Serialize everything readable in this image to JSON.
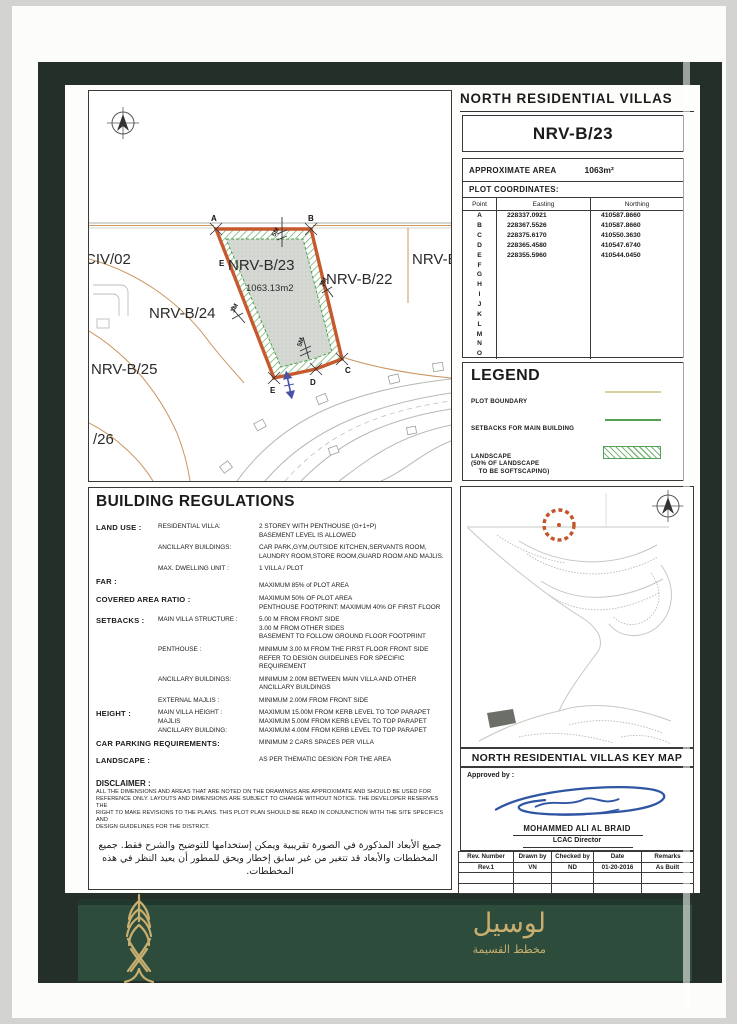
{
  "header": {
    "title": "NORTH RESIDENTIAL VILLAS",
    "plot_number": "NRV-B/23"
  },
  "area_box": {
    "label": "APPROXIMATE AREA",
    "value": "1063m²"
  },
  "coordinates": {
    "title": "PLOT COORDINATES:",
    "columns": [
      "Point",
      "Easting",
      "Northing"
    ],
    "rows": [
      {
        "point": "A",
        "easting": "228337.0921",
        "northing": "410587.8660"
      },
      {
        "point": "B",
        "easting": "228367.5526",
        "northing": "410587.8660"
      },
      {
        "point": "C",
        "easting": "228375.6170",
        "northing": "410550.3630"
      },
      {
        "point": "D",
        "easting": "228365.4580",
        "northing": "410547.6740"
      },
      {
        "point": "E",
        "easting": "228355.5960",
        "northing": "410544.0450"
      },
      {
        "point": "F",
        "easting": "",
        "northing": ""
      },
      {
        "point": "G",
        "easting": "",
        "northing": ""
      },
      {
        "point": "H",
        "easting": "",
        "northing": ""
      },
      {
        "point": "I",
        "easting": "",
        "northing": ""
      },
      {
        "point": "J",
        "easting": "",
        "northing": ""
      },
      {
        "point": "K",
        "easting": "",
        "northing": ""
      },
      {
        "point": "L",
        "easting": "",
        "northing": ""
      },
      {
        "point": "M",
        "easting": "",
        "northing": ""
      },
      {
        "point": "N",
        "easting": "",
        "northing": ""
      },
      {
        "point": "O",
        "easting": "",
        "northing": ""
      }
    ]
  },
  "legend": {
    "title": "LEGEND",
    "items": [
      {
        "label": "PLOT BOUNDARY",
        "symbol": "plot-boundary-line"
      },
      {
        "label": "SETBACKS FOR MAIN BUILDING",
        "symbol": "setback-line"
      },
      {
        "label": "LANDSCAPE\n(50% OF LANDSCAPE\n    TO BE SOFTSCAPING)",
        "symbol": "landscape-hatch"
      },
      {
        "label": "CONTOUR (ALL LEVELS ARE\n        SHOWN TO QNHD)",
        "symbol": "contour-line"
      },
      {
        "label": "PLOT VEHICULAR ACCESS",
        "symbol": "vehicular-access-arrow"
      }
    ]
  },
  "site_plan": {
    "labels": {
      "civ02": "CIV/02",
      "plot23": "NRV-B/23",
      "plot23_area": "1063.13m2",
      "plot22": "NRV-B/22",
      "plotB": "NRV-B",
      "plot24": "NRV-B/24",
      "plot25": "NRV-B/25",
      "plot26": "/26",
      "ptA": "A",
      "ptB": "B",
      "ptC": "C",
      "ptD": "D",
      "ptE": "E",
      "ptE2": "E"
    },
    "dimensions": {
      "top": "5M",
      "right": "3M",
      "left": "3M",
      "bottom": "5M"
    }
  },
  "key_map": {
    "title": "NORTH RESIDENTIAL VILLAS KEY MAP"
  },
  "regulations": {
    "title": "BUILDING REGULATIONS",
    "rows": [
      {
        "label": "LAND USE :",
        "sub": "RESIDENTIAL VILLA:",
        "value": "2 STOREY WITH PENTHOUSE  (G+1+P)\nBASEMENT LEVEL IS ALLOWED"
      },
      {
        "label": "",
        "sub": "ANCILLARY BUILDINGS:",
        "value": "CAR PARK,GYM,OUTSIDE KITCHEN,SERVANTS ROOM,\nLAUNDRY ROOM,STORE ROOM,GUARD ROOM AND MAJLIS."
      },
      {
        "label": "",
        "sub": "MAX. DWELLING UNIT :",
        "value": "1 VILLA / PLOT"
      },
      {
        "label": "FAR :",
        "sub": "",
        "value": "MAXIMUM 85% of PLOT AREA"
      },
      {
        "label": "COVERED AREA RATIO :",
        "sub": "",
        "value": "MAXIMUM 50% OF PLOT AREA\nPENTHOUSE FOOTPRINT: MAXIMUM 40% OF FIRST FLOOR"
      },
      {
        "label": "SETBACKS :",
        "sub": "MAIN VILLA STRUCTURE :",
        "value": "5.00 M FROM FRONT SIDE\n3.00 M FROM OTHER SIDES\nBASEMENT TO FOLLOW GROUND FLOOR FOOTPRINT"
      },
      {
        "label": "",
        "sub": "PENTHOUSE :",
        "value": "MINIMUM 3.00 M FROM THE FIRST FLOOR FRONT SIDE\nREFER TO DESIGN GUIDELINES FOR SPECIFIC REQUIREMENT"
      },
      {
        "label": "",
        "sub": "ANCILLARY BUILDINGS:",
        "value": "MINIMUM 2.00M BETWEEN MAIN VILLA AND OTHER\nANCILLARY BUILDINGS"
      },
      {
        "label": "",
        "sub": "EXTERNAL MAJLIS :",
        "value": "MINIMUM 2.00M FROM FRONT SIDE"
      },
      {
        "label": "HEIGHT :",
        "sub": "MAIN VILLA HEIGHT :\nMAJLIS\nANCILLARY BUILDING:",
        "value": "MAXIMUM 15.00M FROM KERB LEVEL TO TOP PARAPET\nMAXIMUM 5.00M FROM KERB LEVEL TO TOP PARAPET\nMAXIMUM 4.00M FROM KERB LEVEL TO TOP PARAPET"
      },
      {
        "label": "CAR PARKING REQUIREMENTS:",
        "sub": "",
        "value": "MINIMUM 2 CARS SPACES PER VILLA"
      },
      {
        "label": "LANDSCAPE :",
        "sub": "",
        "value": "AS PER THEMATIC DESIGN FOR THE AREA"
      }
    ]
  },
  "disclaimer": {
    "title": "DISCLAIMER :",
    "body": "ALL THE DIMENSIONS AND AREAS THAT ARE NOTED ON THE DRAWINGS ARE  APPROXIMATE AND SHOULD BE USED FOR\nREFERENCE ONLY.  LAYOUTS AND DIMENSIONS ARE SUBJECT TO CHANGE WITHOUT NOTICE.  THE DEVELOPER RESERVES THE\nRIGHT TO MAKE REVISIONS TO  THE PLANS. THIS PLOT PLAN SHOULD BE READ IN CONJUNCTION WITH THE SITE SPECIFICS AND\nDESIGN GUIDELINES FOR THE DISTRICT.",
    "arabic": "جميع الأبعاد المذكورة في الصورة تقريبية ويمكن إستخدامها للتوضيح والشرح فقط. جميع المخططات والأبعاد قد تتغير من غير سابق إخطار ويحق للمطور أن يعيد النظر في هذه المخططات."
  },
  "approval": {
    "label": "Approved by :",
    "name": "MOHAMMED ALI AL BRAID",
    "role": "LCAC Director"
  },
  "revision_table": {
    "columns": [
      "Rev. Number",
      "Drawn by",
      "Checked by",
      "Date",
      "Remarks"
    ],
    "rows": [
      [
        "Rev.1",
        "VN",
        "ND",
        "01-20-2016",
        "As Built"
      ],
      [
        "",
        "",
        "",
        "",
        ""
      ],
      [
        "",
        "",
        "",
        "",
        ""
      ]
    ]
  },
  "footer": {
    "brand_ar": "لوسيل",
    "subtitle_ar": "مخطط القسيمة"
  },
  "colors": {
    "plot_boundary": "#c65a2e",
    "setback_green": "#56a156",
    "legend_tan": "#ddd0a0",
    "contour_gray": "#e2e2dc",
    "access_blue": "#4a52a6",
    "signature_blue": "#2f55a4",
    "frame_green": "#232f28",
    "band_green": "#2e4c3b",
    "gold": "#c9af6f"
  }
}
